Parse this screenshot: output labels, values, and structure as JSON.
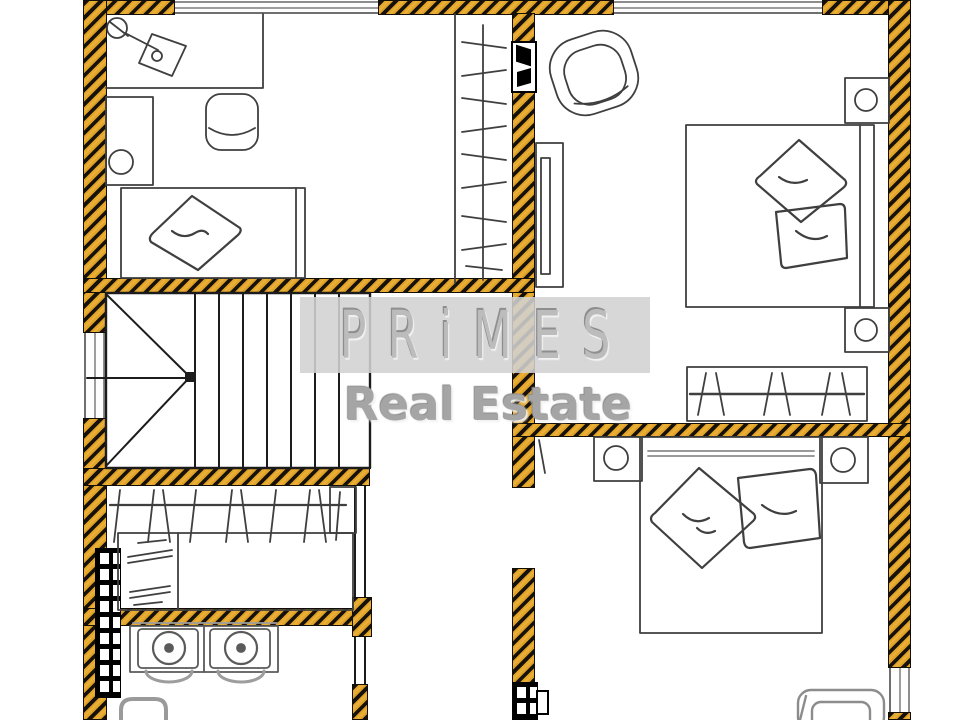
{
  "watermark": {
    "brand": "PRiMES",
    "tagline": "Real Estate"
  },
  "palette": {
    "wall_fill": "#D79A1E",
    "wall_stripe": "#16110A",
    "drawing_line": "#3F3F3F",
    "secondary_line": "#8C8C8C",
    "watermark_band": "#D1D1D1",
    "watermark_text": "#A5A5A5",
    "background": "#FFFFFF"
  },
  "symbols": [
    "desk-lamp-icon",
    "desk-icon",
    "office-chair-icon",
    "stool-icon",
    "single-bed-icon",
    "pillow-icon",
    "hanging-rail-icon",
    "armchair-icon",
    "wardrobe-icon",
    "double-bed-icon",
    "nightstand-lamp-icon",
    "staircase-icon",
    "double-sink-vanity-icon",
    "bathtub-corner-icon",
    "window-icon",
    "door-opening-icon",
    "shaft-grid-icon"
  ]
}
